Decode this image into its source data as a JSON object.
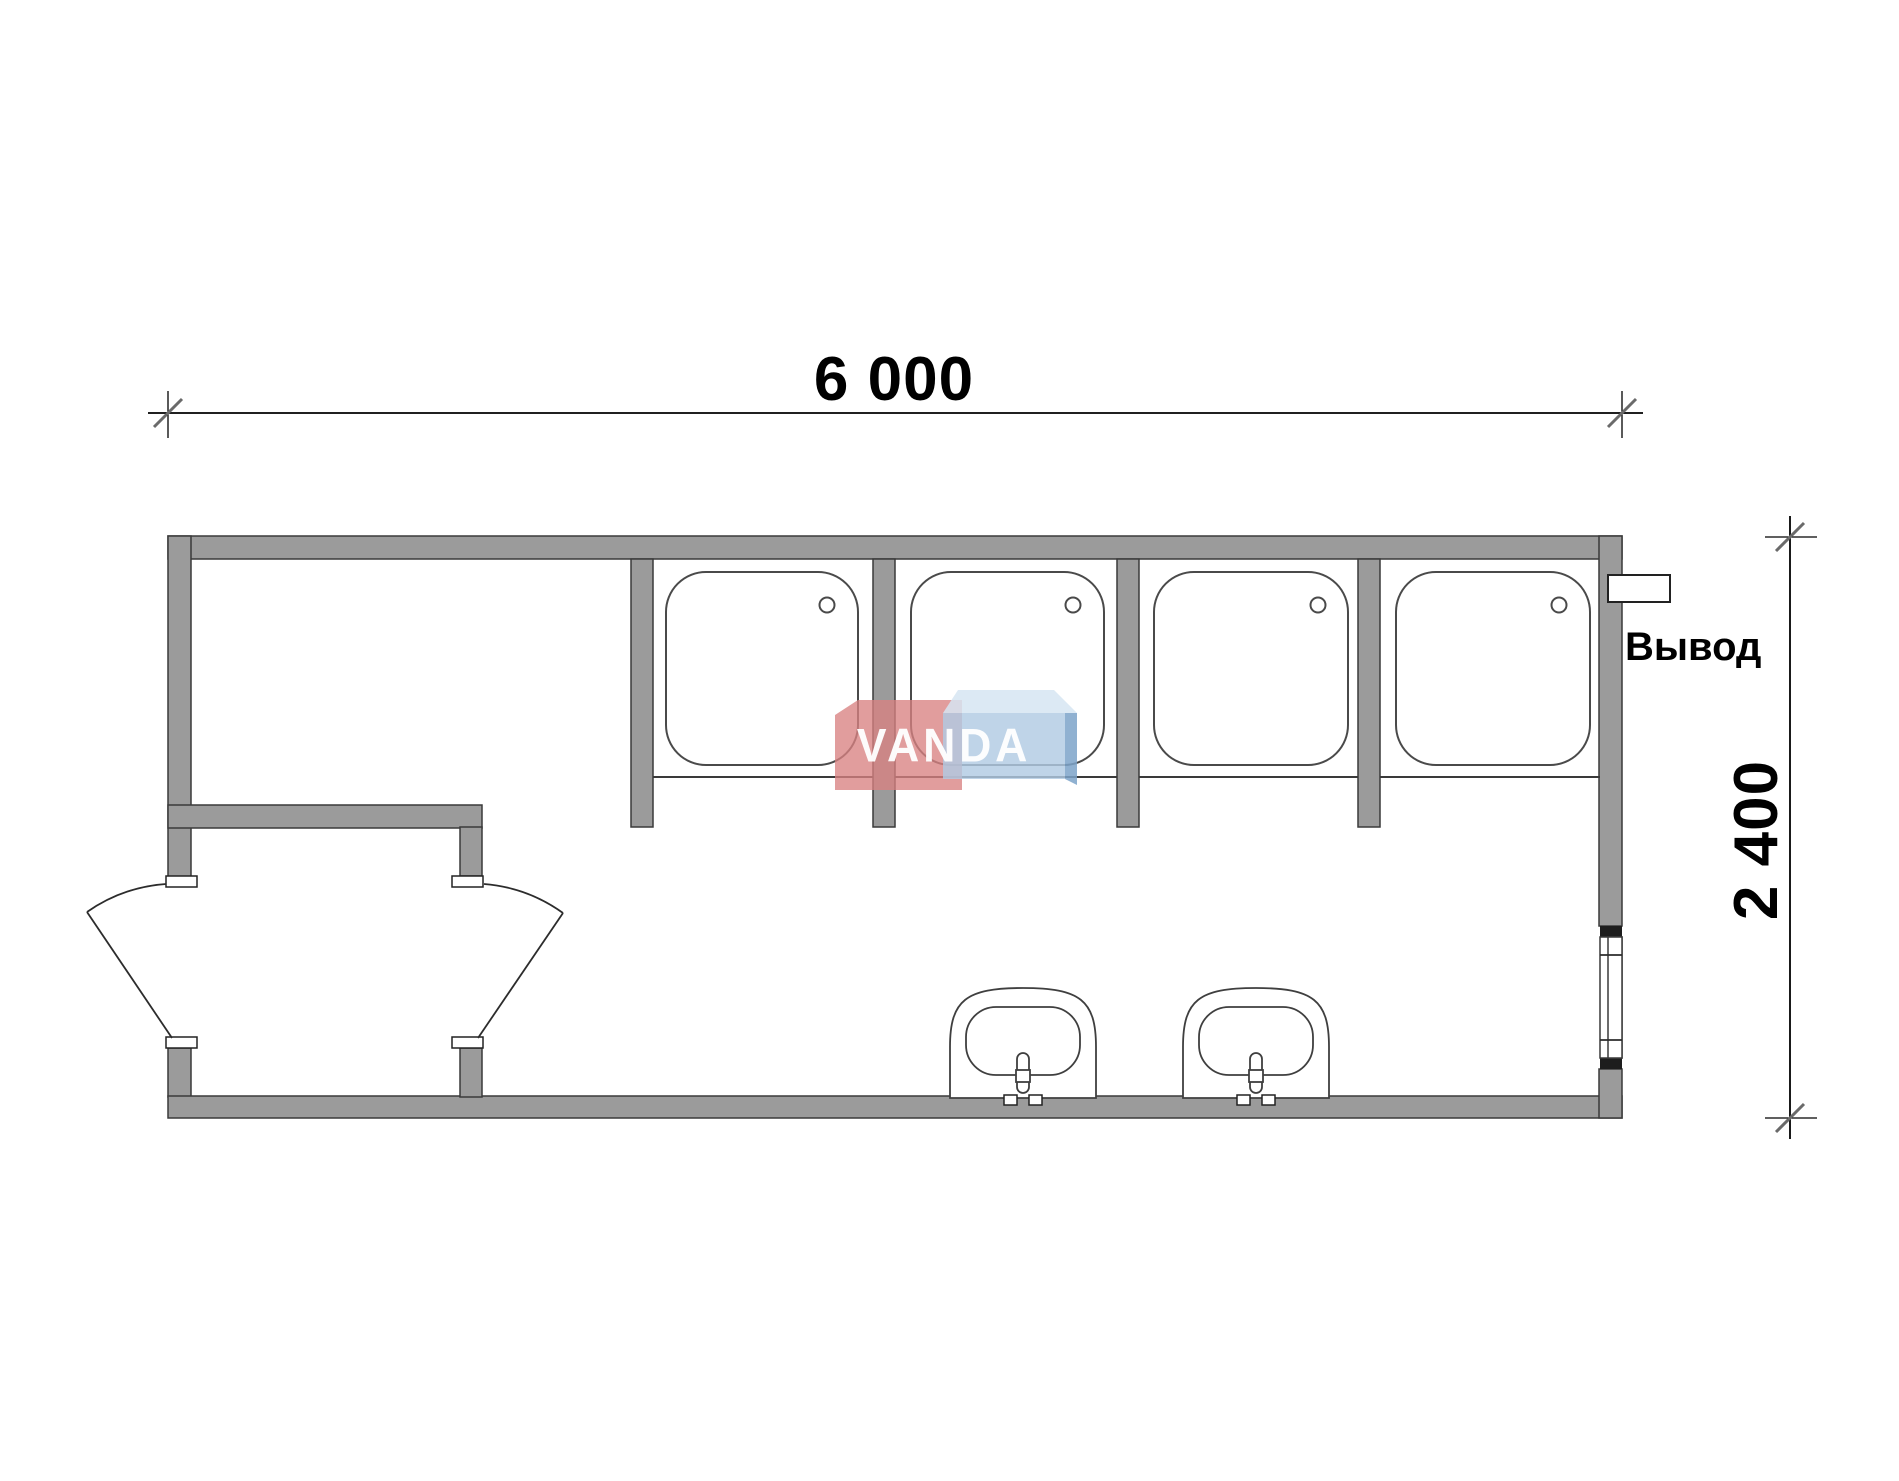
{
  "dimensions": {
    "width_label": "6 000",
    "height_label": "2 400"
  },
  "labels": {
    "outlet_label": "Вывод"
  },
  "watermark": {
    "brand": "VANDA"
  },
  "fixtures": {
    "shower_tray_count": 4,
    "sink_count": 2,
    "door_leaf_count": 2,
    "window_count": 1
  },
  "colors": {
    "wall_fill": "#9b9b9b",
    "wall_edge": "#3a3a3a",
    "line": "#2c2c2c",
    "dim_line": "#000000",
    "tick": "#6a6a6a",
    "bg": "#ffffff",
    "wm_red": "#d88282",
    "wm_blue_front": "#b1cbe3",
    "wm_blue_top": "#d6e5f2",
    "wm_blue_side": "#7da3c9",
    "wm_text": "#ffffff"
  }
}
